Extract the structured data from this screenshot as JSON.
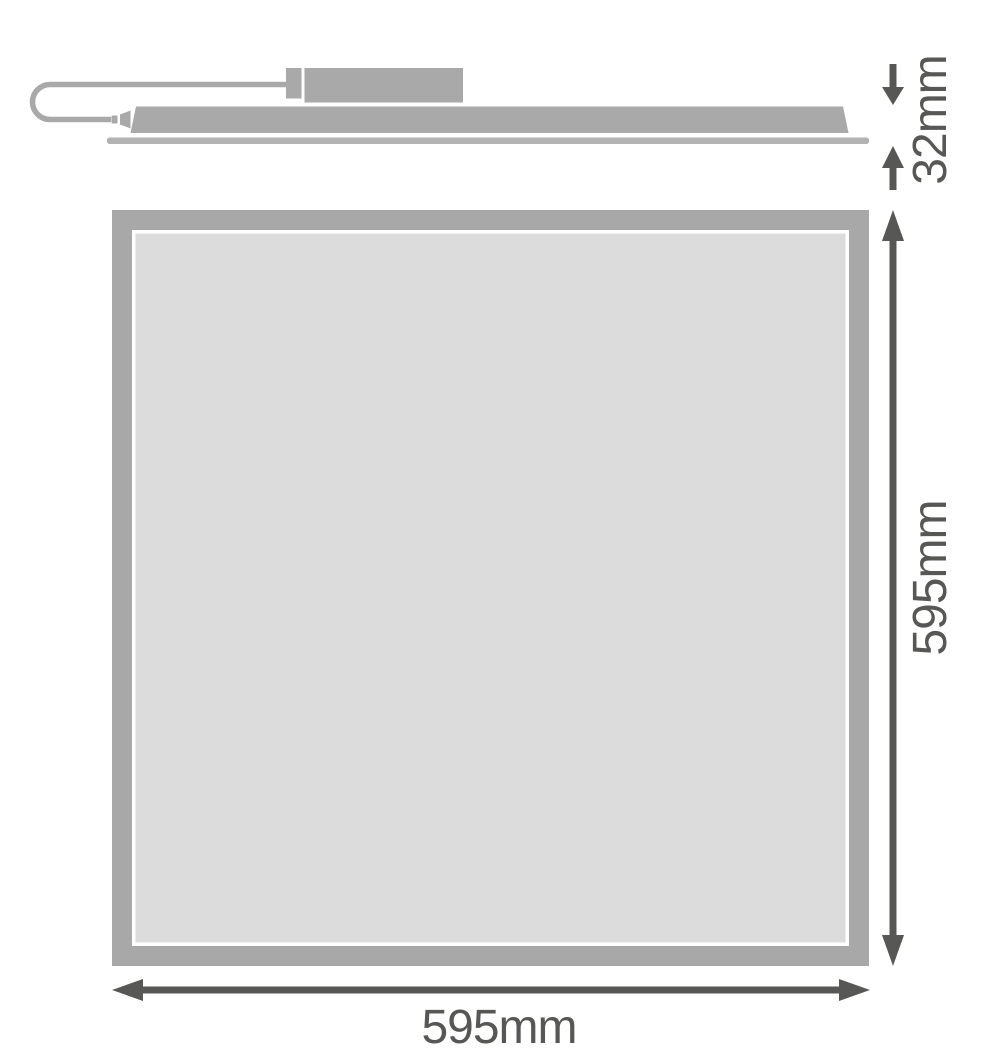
{
  "dimensions": {
    "thickness": {
      "label": "32mm"
    },
    "height": {
      "label": "595mm"
    },
    "width": {
      "label": "595mm"
    }
  },
  "colors": {
    "shape_gray": "#a9a9a9",
    "flange_gray": "#b3b3b3",
    "frame_gray": "#a8a8a8",
    "diffuser_gray": "#dcdcdc",
    "dimension_color": "#575756",
    "background": "#ffffff"
  }
}
